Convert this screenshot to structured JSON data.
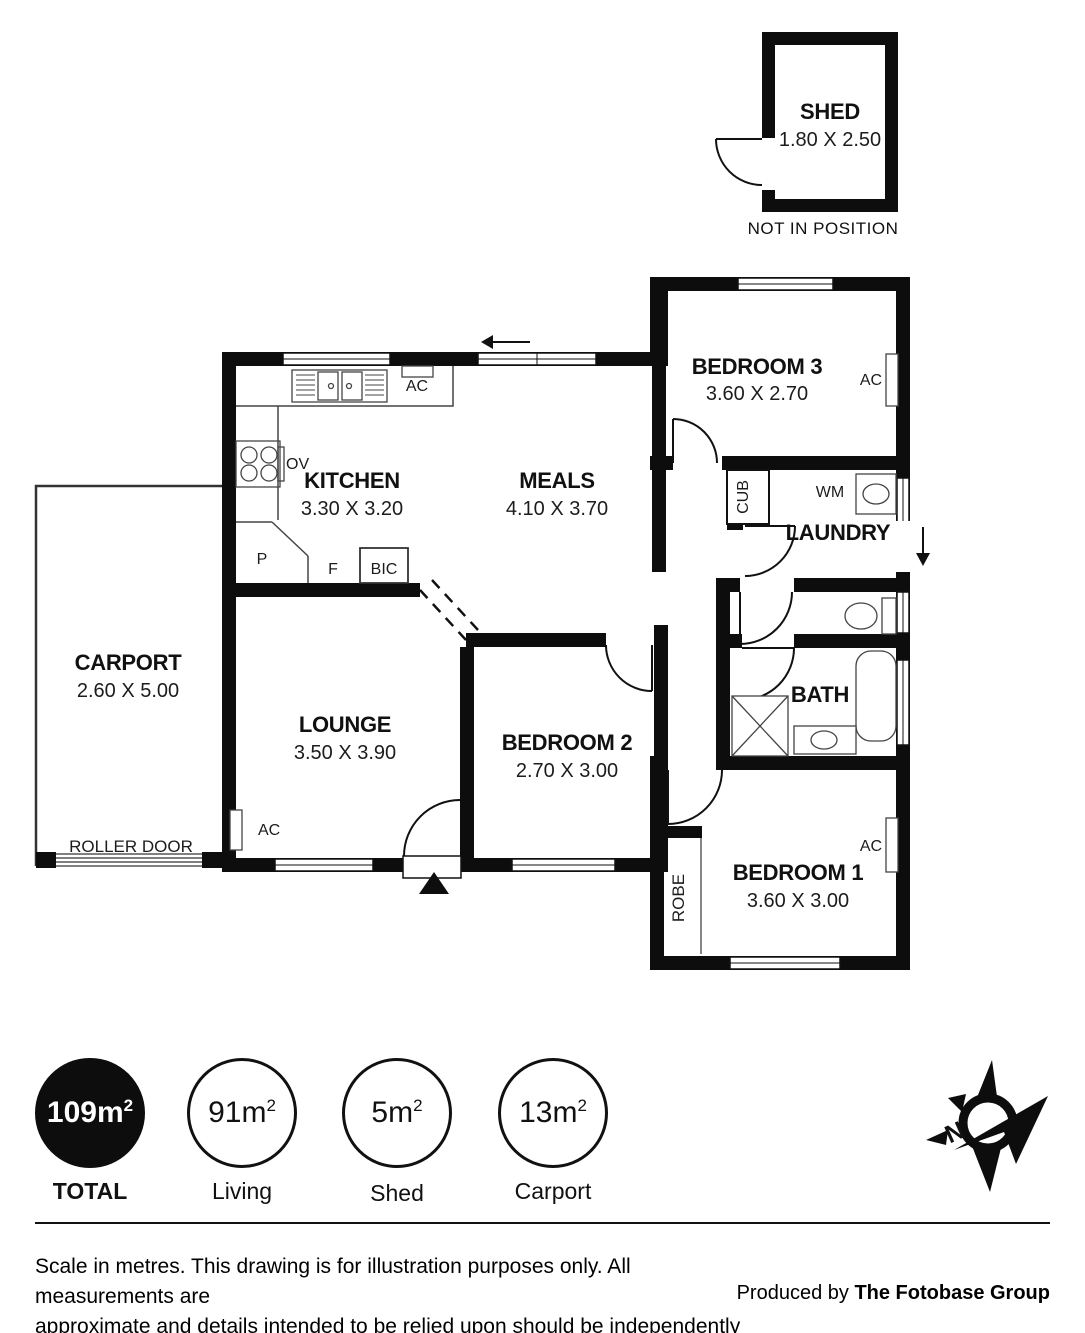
{
  "plan": {
    "shed": {
      "name": "SHED",
      "dims": "1.80 X 2.50",
      "note": "NOT IN POSITION"
    },
    "rooms": {
      "bedroom3": {
        "name": "BEDROOM 3",
        "dims": "3.60 X 2.70"
      },
      "kitchen": {
        "name": "KITCHEN",
        "dims": "3.30 X 3.20"
      },
      "meals": {
        "name": "MEALS",
        "dims": "4.10 X 3.70"
      },
      "laundry": {
        "name": "LAUNDRY"
      },
      "bath": {
        "name": "BATH"
      },
      "carport": {
        "name": "CARPORT",
        "dims": "2.60 X 5.00"
      },
      "lounge": {
        "name": "LOUNGE",
        "dims": "3.50 X 3.90"
      },
      "bedroom2": {
        "name": "BEDROOM 2",
        "dims": "2.70 X 3.00"
      },
      "bedroom1": {
        "name": "BEDROOM 1",
        "dims": "3.60 X 3.00"
      }
    },
    "fixtures": {
      "ac": "AC",
      "wm": "WM",
      "cub": "CUB",
      "robe": "ROBE",
      "ov": "OV",
      "pantry": "P",
      "fridge": "F",
      "bic": "BIC",
      "roller_door": "ROLLER DOOR"
    }
  },
  "summary": {
    "items": [
      {
        "area": "109m",
        "sup": "2",
        "label": "TOTAL",
        "filled": true
      },
      {
        "area": "91m",
        "sup": "2",
        "label": "Living",
        "filled": false
      },
      {
        "area": "5m",
        "sup": "2",
        "label": "Shed",
        "filled": false
      },
      {
        "area": "13m",
        "sup": "2",
        "label": "Carport",
        "filled": false
      }
    ]
  },
  "footer": {
    "disclaimer_line1": "Scale in metres. This drawing is for illustration purposes only. All measurements are",
    "disclaimer_line2": "approximate and details intended to be relied upon should be independently verified.",
    "produced_by": "Produced by ",
    "producer": "The Fotobase Group"
  }
}
